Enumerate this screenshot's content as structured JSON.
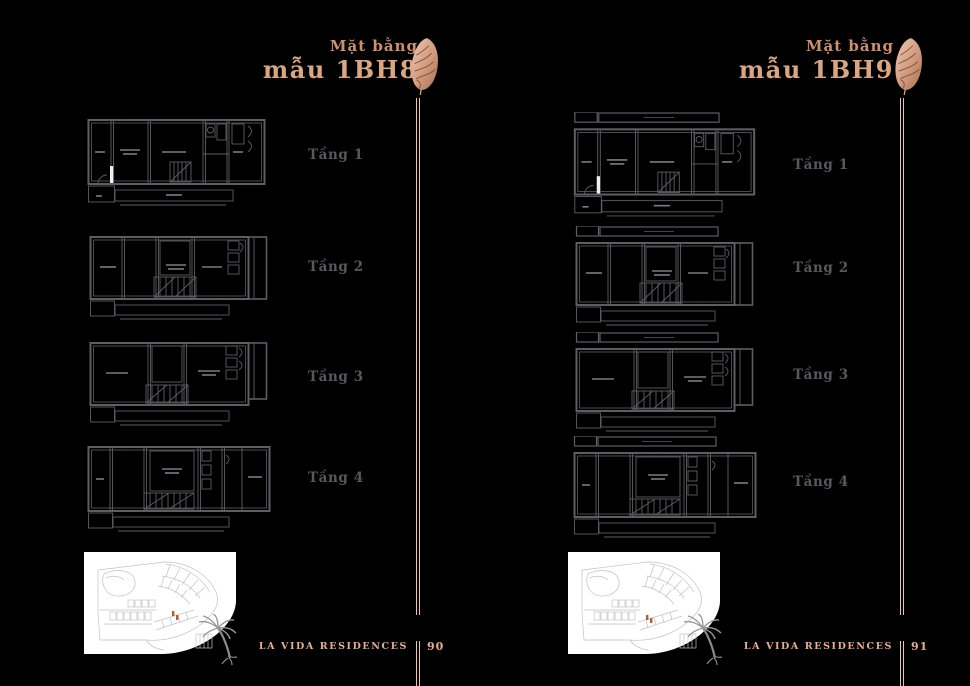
{
  "document": {
    "kind": "floor-plan brochure spread"
  },
  "pages": [
    {
      "title_small": "Mặt bằng",
      "title_large": "mẫu 1BH8",
      "floors": [
        {
          "label": "Tầng 1"
        },
        {
          "label": "Tầng 2"
        },
        {
          "label": "Tầng 3"
        },
        {
          "label": "Tầng 4"
        }
      ],
      "footer_brand": "LA VIDA RESIDENCES",
      "page_number": "90"
    },
    {
      "title_small": "Mặt bằng",
      "title_large": "mẫu 1BH9",
      "floors": [
        {
          "label": "Tầng 1"
        },
        {
          "label": "Tầng 2"
        },
        {
          "label": "Tầng 3"
        },
        {
          "label": "Tầng 4"
        }
      ],
      "footer_brand": "LA VIDA RESIDENCES",
      "page_number": "91"
    }
  ],
  "icons": {
    "feather": "feather-ornament-icon",
    "palm": "palm-tree-icon"
  },
  "colors": {
    "background": "#000000",
    "title_copper_small": "#cf8f6b",
    "title_copper_large": "#dba67f",
    "divider_copper": "#eec2a4",
    "footer_copper": "#e9ae8d",
    "plan_stroke": "#5d5e63",
    "floor_label_gray": "#57585e",
    "site_card_bg": "#ffffff",
    "site_plan_stroke": "#c2c2c2",
    "site_highlight_orange": "#b85c28",
    "palm_gray": "#999999"
  }
}
